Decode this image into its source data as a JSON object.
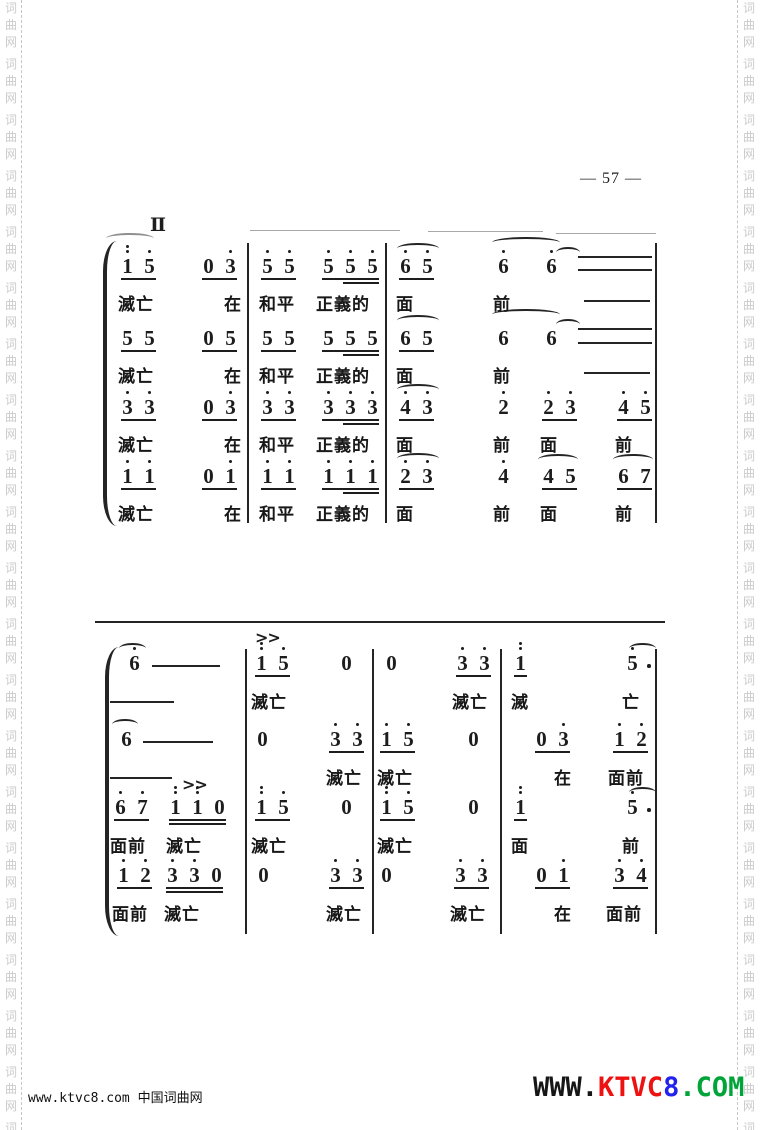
{
  "page": {
    "number_label": "— 57 —",
    "section_label": "Ⅱ",
    "bg": "#ffffff",
    "ink": "#1d1d1d"
  },
  "watermark": {
    "chars": [
      "词",
      "曲",
      "网"
    ],
    "groups": 21,
    "color": "#cbcbcb",
    "dash_color": "#c6c6c6"
  },
  "footer": {
    "left_text": "www.ktvc8.com 中国词曲网",
    "logo_segments": [
      {
        "text": "WWW.",
        "color": "#161616"
      },
      {
        "text": "KTVC",
        "color": "#ee1111"
      },
      {
        "text": "8",
        "color": "#2222ee"
      },
      {
        "text": ".COM",
        "color": "#00a438"
      }
    ]
  },
  "music": {
    "systems": [
      {
        "brace": {
          "x": 103,
          "y1": 241,
          "y2": 526
        },
        "barlines": [
          {
            "x": 247,
            "y1": 243,
            "y2": 523
          },
          {
            "x": 385,
            "y1": 243,
            "y2": 523
          },
          {
            "x": 655,
            "y1": 243,
            "y2": 523
          }
        ],
        "lines": [
          {
            "x": 250,
            "y": 230,
            "w": 150,
            "light": 1
          },
          {
            "x": 428,
            "y": 231,
            "w": 115,
            "light": 1
          },
          {
            "x": 556,
            "y": 233,
            "w": 100,
            "light": 1
          },
          {
            "x": 578,
            "y": 256,
            "w": 74
          },
          {
            "x": 578,
            "y": 269,
            "w": 74
          },
          {
            "x": 584,
            "y": 300,
            "w": 66
          },
          {
            "x": 578,
            "y": 328,
            "w": 74
          },
          {
            "x": 578,
            "y": 342,
            "w": 74
          },
          {
            "x": 584,
            "y": 372,
            "w": 66
          }
        ],
        "slurs": [
          {
            "x": 106,
            "y": 233,
            "w": 48,
            "light": 1
          },
          {
            "x": 397,
            "y": 243,
            "w": 42
          },
          {
            "x": 492,
            "y": 237,
            "w": 68
          },
          {
            "x": 556,
            "y": 247,
            "w": 24
          },
          {
            "x": 397,
            "y": 315,
            "w": 42
          },
          {
            "x": 492,
            "y": 309,
            "w": 68
          },
          {
            "x": 556,
            "y": 319,
            "w": 24
          },
          {
            "x": 397,
            "y": 384,
            "w": 42
          },
          {
            "x": 397,
            "y": 453,
            "w": 42
          },
          {
            "x": 538,
            "y": 454,
            "w": 40
          },
          {
            "x": 613,
            "y": 454,
            "w": 40
          }
        ],
        "accents": [],
        "voices": [
          {
            "note_y": 254,
            "lyric_y": 290,
            "cells": [
              {
                "x": 121,
                "n": [
                  "1:2",
                  "5:1"
                ],
                "ul": 1
              },
              {
                "x": 202,
                "n": [
                  "0",
                  "3:1"
                ],
                "ul": 1
              },
              {
                "x": 261,
                "n": [
                  "5:1",
                  "5:1"
                ],
                "ul": 1
              },
              {
                "x": 322,
                "n": [
                  "5:1",
                  "5:1",
                  "5:1"
                ],
                "ul": 1,
                "ul2": "part"
              },
              {
                "x": 399,
                "n": [
                  "6:1",
                  "5:1"
                ],
                "ul": 1
              },
              {
                "x": 497,
                "n": [
                  "6:1"
                ]
              },
              {
                "x": 545,
                "n": [
                  "6:1"
                ]
              }
            ],
            "lyrics": [
              {
                "x": 118,
                "t": "滅亡"
              },
              {
                "x": 224,
                "t": "在"
              },
              {
                "x": 259,
                "t": "和平"
              },
              {
                "x": 316,
                "t": "正義的"
              },
              {
                "x": 396,
                "t": "面"
              },
              {
                "x": 493,
                "t": "前"
              }
            ]
          },
          {
            "note_y": 326,
            "lyric_y": 362,
            "cells": [
              {
                "x": 121,
                "n": [
                  "5",
                  "5"
                ],
                "ul": 1
              },
              {
                "x": 202,
                "n": [
                  "0",
                  "5"
                ],
                "ul": 1
              },
              {
                "x": 261,
                "n": [
                  "5",
                  "5"
                ],
                "ul": 1
              },
              {
                "x": 322,
                "n": [
                  "5",
                  "5",
                  "5"
                ],
                "ul": 1,
                "ul2": "part"
              },
              {
                "x": 399,
                "n": [
                  "6",
                  "5"
                ],
                "ul": 1
              },
              {
                "x": 497,
                "n": [
                  "6"
                ]
              },
              {
                "x": 545,
                "n": [
                  "6"
                ]
              }
            ],
            "lyrics": [
              {
                "x": 118,
                "t": "滅亡"
              },
              {
                "x": 224,
                "t": "在"
              },
              {
                "x": 259,
                "t": "和平"
              },
              {
                "x": 316,
                "t": "正義的"
              },
              {
                "x": 396,
                "t": "面"
              },
              {
                "x": 493,
                "t": "前"
              }
            ]
          },
          {
            "note_y": 395,
            "lyric_y": 431,
            "cells": [
              {
                "x": 121,
                "n": [
                  "3:1",
                  "3:1"
                ],
                "ul": 1
              },
              {
                "x": 202,
                "n": [
                  "0",
                  "3:1"
                ],
                "ul": 1
              },
              {
                "x": 261,
                "n": [
                  "3:1",
                  "3:1"
                ],
                "ul": 1
              },
              {
                "x": 322,
                "n": [
                  "3:1",
                  "3:1",
                  "3:1"
                ],
                "ul": 1,
                "ul2": "part"
              },
              {
                "x": 399,
                "n": [
                  "4:1",
                  "3:1"
                ],
                "ul": 1
              },
              {
                "x": 497,
                "n": [
                  "2:1"
                ]
              },
              {
                "x": 542,
                "n": [
                  "2:1",
                  "3:1"
                ],
                "ul": 1
              },
              {
                "x": 617,
                "n": [
                  "4:1",
                  "5:1"
                ],
                "ul": 1
              }
            ],
            "lyrics": [
              {
                "x": 118,
                "t": "滅亡"
              },
              {
                "x": 224,
                "t": "在"
              },
              {
                "x": 259,
                "t": "和平"
              },
              {
                "x": 316,
                "t": "正義的"
              },
              {
                "x": 396,
                "t": "面"
              },
              {
                "x": 493,
                "t": "前"
              },
              {
                "x": 540,
                "t": "面"
              },
              {
                "x": 615,
                "t": "前"
              }
            ]
          },
          {
            "note_y": 464,
            "lyric_y": 500,
            "cells": [
              {
                "x": 121,
                "n": [
                  "1:1",
                  "1:1"
                ],
                "ul": 1
              },
              {
                "x": 202,
                "n": [
                  "0",
                  "1:1"
                ],
                "ul": 1
              },
              {
                "x": 261,
                "n": [
                  "1:1",
                  "1:1"
                ],
                "ul": 1
              },
              {
                "x": 322,
                "n": [
                  "1:1",
                  "1:1",
                  "1:1"
                ],
                "ul": 1,
                "ul2": "part"
              },
              {
                "x": 399,
                "n": [
                  "2:1",
                  "3:1"
                ],
                "ul": 1
              },
              {
                "x": 497,
                "n": [
                  "4:1"
                ]
              },
              {
                "x": 542,
                "n": [
                  "4",
                  "5"
                ],
                "ul": 1
              },
              {
                "x": 617,
                "n": [
                  "6",
                  "7"
                ],
                "ul": 1
              }
            ],
            "lyrics": [
              {
                "x": 118,
                "t": "滅亡"
              },
              {
                "x": 224,
                "t": "在"
              },
              {
                "x": 259,
                "t": "和平"
              },
              {
                "x": 316,
                "t": "正義的"
              },
              {
                "x": 396,
                "t": "面"
              },
              {
                "x": 493,
                "t": "前"
              },
              {
                "x": 540,
                "t": "面"
              },
              {
                "x": 615,
                "t": "前"
              }
            ]
          }
        ]
      },
      {
        "brace": {
          "x": 105,
          "y1": 647,
          "y2": 936
        },
        "barlines": [
          {
            "x": 245,
            "y1": 649,
            "y2": 934
          },
          {
            "x": 372,
            "y1": 649,
            "y2": 934
          },
          {
            "x": 500,
            "y1": 649,
            "y2": 934
          },
          {
            "x": 655,
            "y1": 649,
            "y2": 934
          }
        ],
        "lines": [
          {
            "x": 95,
            "y": 621,
            "w": 570
          },
          {
            "x": 152,
            "y": 665,
            "w": 68
          },
          {
            "x": 110,
            "y": 701,
            "w": 64
          },
          {
            "x": 143,
            "y": 741,
            "w": 70
          },
          {
            "x": 110,
            "y": 777,
            "w": 62
          }
        ],
        "slurs": [
          {
            "x": 119,
            "y": 643,
            "w": 27
          },
          {
            "x": 112,
            "y": 719,
            "w": 26
          },
          {
            "x": 629,
            "y": 643,
            "w": 27
          },
          {
            "x": 629,
            "y": 787,
            "w": 27
          }
        ],
        "accents": [
          {
            "x": 255,
            "y": 628,
            "label": ">>"
          },
          {
            "x": 182,
            "y": 775,
            "label": ">>"
          }
        ],
        "voices": [
          {
            "note_y": 651,
            "lyric_y": 688,
            "cells": [
              {
                "x": 128,
                "n": [
                  "6:1"
                ]
              },
              {
                "x": 255,
                "n": [
                  "1:2",
                  "5:1"
                ],
                "ul": 1
              },
              {
                "x": 340,
                "n": [
                  "0"
                ]
              },
              {
                "x": 385,
                "n": [
                  "0"
                ]
              },
              {
                "x": 456,
                "n": [
                  "3:1",
                  "3:1"
                ],
                "ul": 1
              },
              {
                "x": 514,
                "n": [
                  "1:2"
                ],
                "ul": 1
              },
              {
                "x": 626,
                "n": [
                  "5:1"
                ],
                "aug": 1
              }
            ],
            "lyrics": [
              {
                "x": 251,
                "t": "滅亡"
              },
              {
                "x": 452,
                "t": "滅亡"
              },
              {
                "x": 511,
                "t": "滅"
              },
              {
                "x": 622,
                "t": "亡"
              }
            ]
          },
          {
            "note_y": 727,
            "lyric_y": 764,
            "cells": [
              {
                "x": 120,
                "n": [
                  "6"
                ]
              },
              {
                "x": 256,
                "n": [
                  "0"
                ]
              },
              {
                "x": 329,
                "n": [
                  "3:1",
                  "3:1"
                ],
                "ul": 1
              },
              {
                "x": 380,
                "n": [
                  "1:1",
                  "5:1"
                ],
                "ul": 1
              },
              {
                "x": 467,
                "n": [
                  "0"
                ]
              },
              {
                "x": 535,
                "n": [
                  "0",
                  "3:1"
                ],
                "ul": 1
              },
              {
                "x": 613,
                "n": [
                  "1:1",
                  "2:1"
                ],
                "ul": 1
              }
            ],
            "lyrics": [
              {
                "x": 326,
                "t": "滅亡"
              },
              {
                "x": 377,
                "t": "滅亡"
              },
              {
                "x": 554,
                "t": "在"
              },
              {
                "x": 608,
                "t": "面前"
              }
            ]
          },
          {
            "note_y": 795,
            "lyric_y": 832,
            "cells": [
              {
                "x": 114,
                "n": [
                  "6:1",
                  "7:1"
                ],
                "ul": 1
              },
              {
                "x": 169,
                "n": [
                  "1:2",
                  "1:2",
                  "0"
                ],
                "ul": 1,
                "ul2": "full"
              },
              {
                "x": 255,
                "n": [
                  "1:2",
                  "5:1"
                ],
                "ul": 1
              },
              {
                "x": 340,
                "n": [
                  "0"
                ]
              },
              {
                "x": 380,
                "n": [
                  "1:2",
                  "5:1"
                ],
                "ul": 1
              },
              {
                "x": 467,
                "n": [
                  "0"
                ]
              },
              {
                "x": 514,
                "n": [
                  "1:2"
                ],
                "ul": 1
              },
              {
                "x": 626,
                "n": [
                  "5:1"
                ],
                "aug": 1
              }
            ],
            "lyrics": [
              {
                "x": 110,
                "t": "面前"
              },
              {
                "x": 166,
                "t": "滅亡"
              },
              {
                "x": 251,
                "t": "滅亡"
              },
              {
                "x": 377,
                "t": "滅亡"
              },
              {
                "x": 511,
                "t": "面"
              },
              {
                "x": 622,
                "t": "前"
              }
            ]
          },
          {
            "note_y": 863,
            "lyric_y": 900,
            "cells": [
              {
                "x": 117,
                "n": [
                  "1:1",
                  "2:1"
                ],
                "ul": 1
              },
              {
                "x": 166,
                "n": [
                  "3:1",
                  "3:1",
                  "0"
                ],
                "ul": 1,
                "ul2": "full"
              },
              {
                "x": 257,
                "n": [
                  "0"
                ]
              },
              {
                "x": 329,
                "n": [
                  "3:1",
                  "3:1"
                ],
                "ul": 1
              },
              {
                "x": 380,
                "n": [
                  "0"
                ]
              },
              {
                "x": 454,
                "n": [
                  "3:1",
                  "3:1"
                ],
                "ul": 1
              },
              {
                "x": 535,
                "n": [
                  "0",
                  "1:1"
                ],
                "ul": 1
              },
              {
                "x": 613,
                "n": [
                  "3:1",
                  "4:1"
                ],
                "ul": 1
              }
            ],
            "lyrics": [
              {
                "x": 112,
                "t": "面前"
              },
              {
                "x": 164,
                "t": "滅亡"
              },
              {
                "x": 326,
                "t": "滅亡"
              },
              {
                "x": 450,
                "t": "滅亡"
              },
              {
                "x": 554,
                "t": "在"
              },
              {
                "x": 606,
                "t": "面前"
              }
            ]
          }
        ]
      }
    ]
  }
}
